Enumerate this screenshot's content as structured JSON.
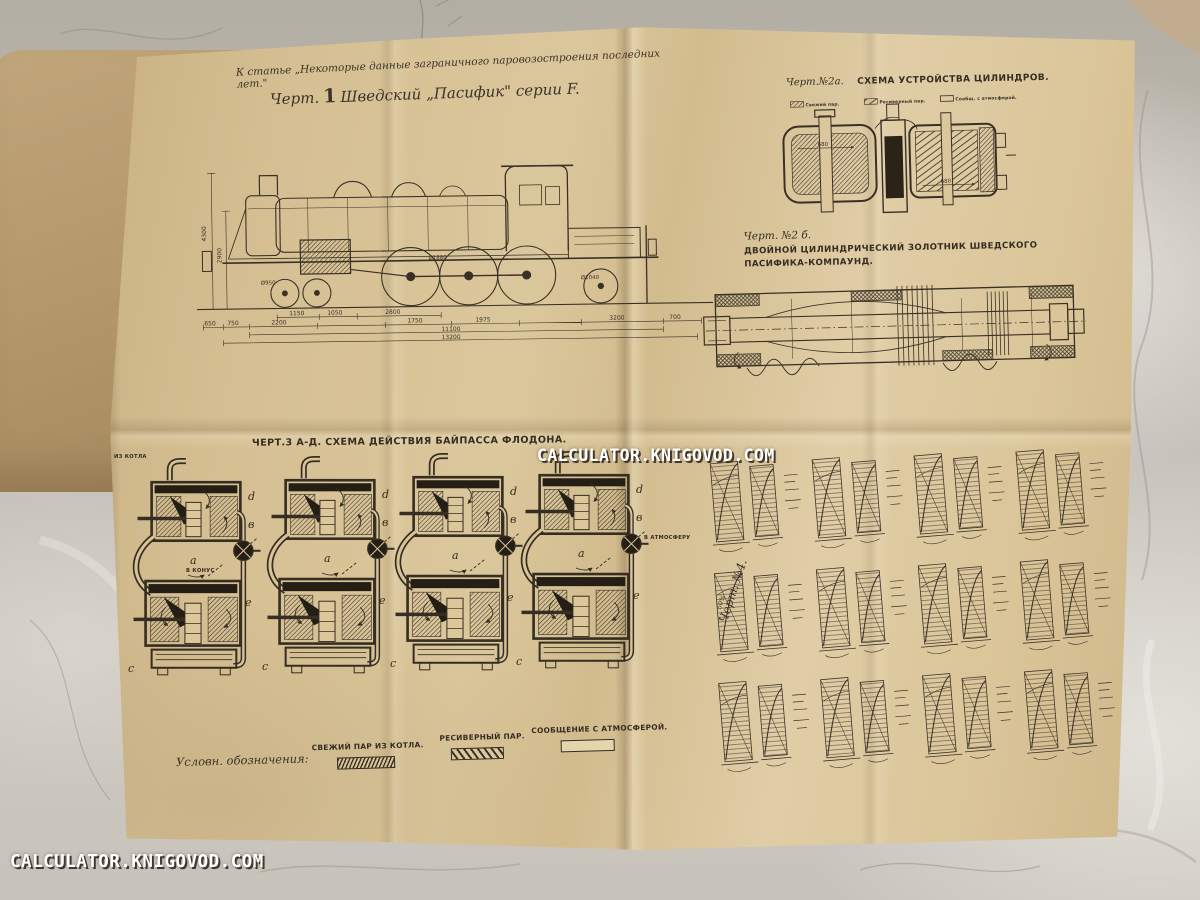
{
  "watermarks": {
    "center": "CALCULATOR.KNIGOVOD.COM",
    "bottom_left": "CALCULATOR.KNIGOVOD.COM"
  },
  "header": {
    "note": "К статье „Некоторые данные заграничного паровозостроения последних лет.\""
  },
  "fig1": {
    "label": "Черт.",
    "number": "1",
    "title": "Шведский „Пасифик\" серии F.",
    "dims": {
      "h1": "4300",
      "h2": "2900",
      "wheel_front": "Ø950",
      "wheel_driver": "Ø1880",
      "wheel_rear": "Ø1040",
      "row0": [
        "1150",
        "1050",
        "2800"
      ],
      "row1": [
        "650",
        "750",
        "2200",
        "1750",
        "1975",
        "3200",
        "700"
      ],
      "total1": "11100",
      "total2": "13200"
    }
  },
  "fig2a": {
    "label": "Черт.№2а.",
    "title": "Схема устройства цилиндров.",
    "legend": [
      "Свежий пар.",
      "Ресиверный пар.",
      "Сообщ. с атмосферой."
    ],
    "dim_left": "680",
    "dim_right": "680"
  },
  "fig2b": {
    "label": "Черт. №2 б.",
    "caption": "Двойной цилиндрический золотник Шведского Пасифика-Компаунд."
  },
  "fig3": {
    "title": "Черт.3 а-д.  Схема действия байпасса Флодона.",
    "diagrams": [
      {
        "top_label": "из котла",
        "side_label": "в конус"
      },
      {
        "top_label": "",
        "side_label": ""
      },
      {
        "top_label": "",
        "side_label": ""
      },
      {
        "top_label": "",
        "side_label": "в атмосферу"
      }
    ],
    "part_letters": [
      "a",
      "в",
      "c",
      "d",
      "e"
    ],
    "captions": [
      {
        "letter": "а)",
        "text": "Положение при закрытом регуляторе."
      },
      {
        "letter": "в)",
        "text": "Трогание с места — работа только большими цилиндр."
      },
      {
        "letter": "с)",
        "text": "Нормальное положение — работа Компоунд. всеми цилиндрами."
      },
      {
        "letter": "д)",
        "text": "Прямоток — работа только малыми цилиндр."
      }
    ],
    "legend_title": "Условн. обозначения:",
    "legend": [
      {
        "label": "Свежий пар из котла.",
        "pattern": "dense"
      },
      {
        "label": "Ресиверный пар.",
        "pattern": "diagonal"
      },
      {
        "label": "Сообщение с атмосферой.",
        "pattern": "empty"
      }
    ]
  },
  "fig4": {
    "label": "Черт. №4.",
    "note": "50%",
    "grid": {
      "cols": 4,
      "rows": 3
    }
  }
}
